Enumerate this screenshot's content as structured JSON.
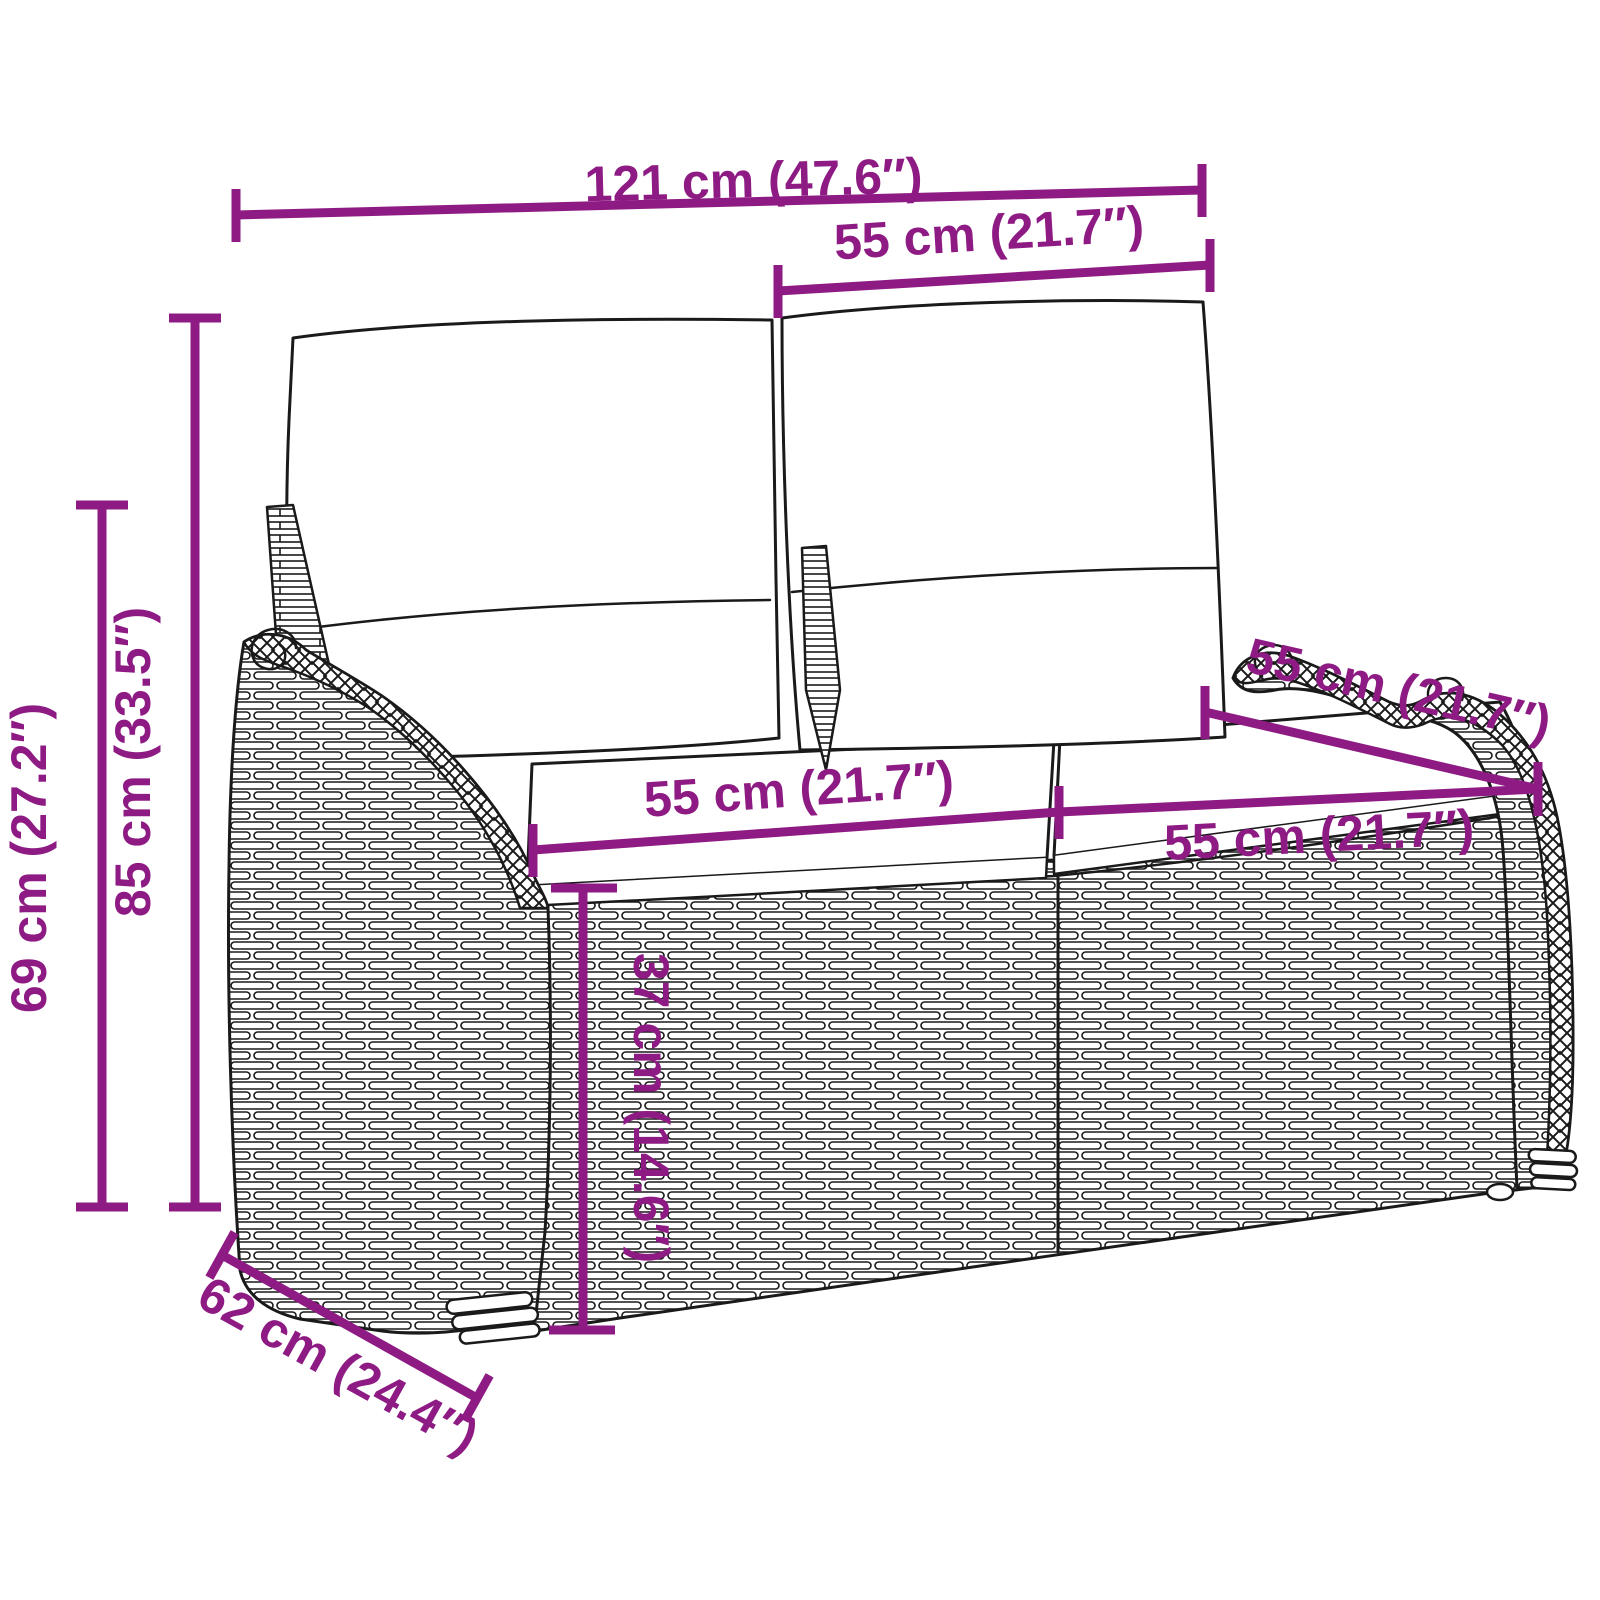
{
  "colors": {
    "accent": "#8E1B84",
    "drawing_line": "#1a1a1a",
    "background": "#FFFFFF"
  },
  "dims": {
    "overall_width": "121 cm (47.6″)",
    "backrest_cushion_width": "55 cm (21.7″)",
    "overall_height": "85 cm (33.5″)",
    "armrest_height": "69 cm (27.2″)",
    "seat_width_left": "55 cm (21.7″)",
    "seat_depth": "55 cm (21.7″)",
    "seat_width_right": "55 cm (21.7″)",
    "seat_height": "37 cm (14.6″)",
    "overall_depth": "62 cm (24.4″)"
  }
}
